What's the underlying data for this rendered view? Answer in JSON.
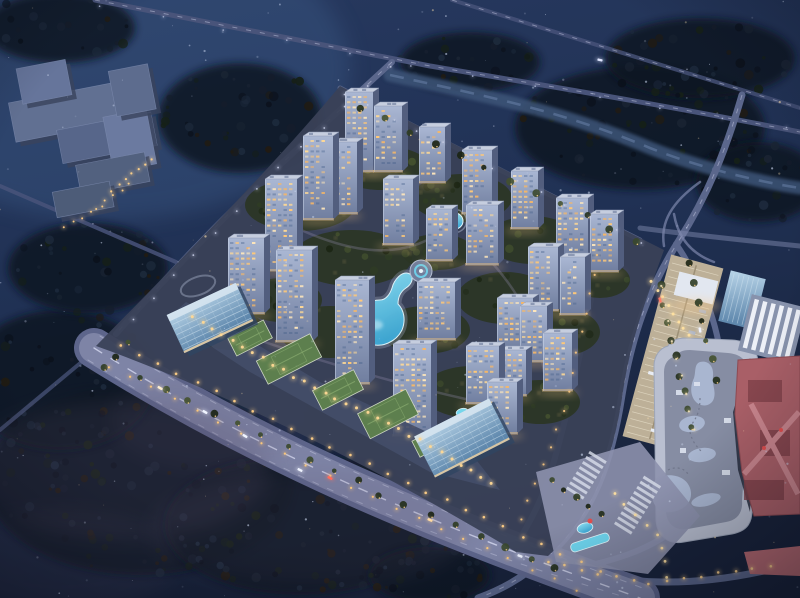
{
  "canvas": {
    "w": 800,
    "h": 598,
    "seed": 20240613
  },
  "palette": {
    "skyTop": "#27395f",
    "skyMid": "#203154",
    "skyLow": "#18223a",
    "glowTL": "#41608f",
    "forestBase": "#0f1420",
    "forestPuffs": [
      "#0b111c",
      "#151d2b",
      "#1a2433",
      "#162017",
      "#211b12",
      "#1d2a3c"
    ],
    "mist": "#5a4f6b",
    "river": "#3e5478",
    "riverHi": "#6d85ad",
    "roadDark": "#49547a",
    "road": "#5b678c",
    "roadLight": "#7d87ac",
    "laneLine": "#c7cce4",
    "avenue": "#7e84a6",
    "avenueEdge": "#5d658b",
    "compound": "#3a4157",
    "greenPatch": "#2b3524",
    "greenPuffs": [
      "#222d1a",
      "#2f3c24",
      "#3a482c",
      "#1b2413",
      "#44512f"
    ],
    "treeWarm": "#ffd28a",
    "towerTop": "#aab7d3",
    "towerBottom": "#707e9f",
    "towerSide": "#525e7e",
    "roof": "#c6cedf",
    "roofUnit": "#8d99b4",
    "winWarm": [
      "#ffd994",
      "#ffc877",
      "#ffe7bb",
      "#f7b766"
    ],
    "winCool": "#3d5884",
    "baseGlow": "#ffcf8e",
    "glassDark": "#5f88ad",
    "glassLine": "#d2e4f0",
    "greenRoof": "#5d7f4e",
    "greenRoofLine": "#86a86d",
    "greenRoofEdge": "#cdd6c2",
    "poolDeep": "#3fa9d6",
    "pool": "#6fd6ef",
    "poolEdge": "#e2f6fc",
    "mall": "#b9bfd0",
    "mallRoof": "#868da3",
    "mallBlob": "#a9b6d0",
    "mallSky": "#dde2ee",
    "tan": "#bdb098",
    "tanLine": "#e6dec9",
    "pink": "#a95f67",
    "pinkDark": "#7e4049",
    "pinkLight": "#c9858d",
    "red": "#e14e4e",
    "plaza": "#8d91ad",
    "stripe": "#dadeeb",
    "speck": "#cfdaf2",
    "speckWarm": "#ffe3b2",
    "schoolShadow": "#39435c",
    "schoolBlocks": [
      "#617092",
      "#57668a",
      "#66759b",
      "#6b7aa0",
      "#52617f",
      "#5d6c8e",
      "#4d5c78"
    ]
  },
  "scene": {
    "forest": [
      [
        140,
        480,
        155,
        95,
        95
      ],
      [
        300,
        525,
        135,
        70,
        70
      ],
      [
        60,
        380,
        95,
        70,
        50
      ],
      [
        430,
        575,
        60,
        28,
        25
      ],
      [
        240,
        118,
        82,
        55,
        42
      ],
      [
        60,
        28,
        75,
        35,
        25
      ],
      [
        640,
        128,
        125,
        62,
        55
      ],
      [
        758,
        182,
        62,
        40,
        25
      ],
      [
        88,
        268,
        80,
        45,
        35
      ],
      [
        700,
        58,
        95,
        40,
        30
      ],
      [
        470,
        62,
        70,
        30,
        22
      ]
    ],
    "river": {
      "d": "M390,75 C480,95 560,110 650,148 C700,168 760,182 800,188"
    },
    "roads": [
      {
        "d": "M95,0 L430,66 C560,88 680,108 800,132",
        "w": 5,
        "c": "roadDark",
        "line": 1
      },
      {
        "d": "M452,0 L800,108",
        "w": 4,
        "c": "roadDark",
        "o": 0.8,
        "line": 1
      },
      {
        "d": "M742,95 C726,150 708,195 678,242 C648,290 632,335 622,395 C612,460 594,515 548,556 C520,580 500,590 478,598",
        "w": 7,
        "c": "road",
        "line": 1
      },
      {
        "d": "M392,62 L268,176 C220,220 158,286 116,334",
        "w": 6,
        "c": "road",
        "line": 1
      },
      {
        "d": "M340,88 C430,135 520,180 640,240",
        "w": 5,
        "c": "road",
        "o": 0.9
      },
      {
        "d": "M600,252 C585,330 572,400 552,468 C545,492 532,520 514,548",
        "w": 6,
        "c": "road"
      },
      {
        "d": "M676,244 C706,288 720,330 724,382 C727,436 718,478 688,516 C664,544 624,560 566,570",
        "w": 6,
        "c": "road"
      },
      {
        "d": "M176,262 L0,186",
        "w": 4,
        "c": "roadDark",
        "o": 0.85
      },
      {
        "d": "M96,350 L0,430",
        "w": 4,
        "c": "roadDark",
        "o": 0.75
      },
      {
        "d": "M640,228 C700,236 760,242 800,246",
        "w": 5,
        "c": "roadLight",
        "o": 0.5
      },
      {
        "d": "M700,182 C672,202 660,222 664,246",
        "w": 2.5,
        "c": "roadLight",
        "o": 0.7
      },
      {
        "d": "M714,262 C692,254 678,238 674,214",
        "w": 2.5,
        "c": "roadLight",
        "o": 0.7
      },
      {
        "d": "M540,560 C620,588 700,590 800,562",
        "w": 7,
        "c": "road"
      },
      {
        "d": "M94,348 C260,452 420,520 640,598",
        "w": 30,
        "c": "avenue",
        "under": {
          "w": 40,
          "c": "avenueEdge"
        }
      },
      {
        "d": "M94,348 C260,452 420,520 640,598",
        "w": 1.4,
        "c": "#d6daf0",
        "o": 0.8,
        "dash": "9 11"
      },
      {
        "d": "M100,336 C266,440 426,508 648,590",
        "w": 1,
        "c": "laneLine",
        "o": 0.5,
        "dash": "6 10"
      },
      {
        "d": "M88,360 C254,464 414,534 628,598",
        "w": 1,
        "c": "laneLine",
        "o": 0.45,
        "dash": "6 10"
      }
    ],
    "mist": [
      [
        120,
        470,
        150,
        70,
        0.2
      ],
      [
        310,
        530,
        160,
        60,
        0.16
      ],
      [
        210,
        420,
        100,
        50,
        0.12
      ],
      [
        60,
        560,
        120,
        50,
        0.15
      ]
    ],
    "compound": {
      "outline": "M340,86 C450,142 560,198 664,250 C646,300 630,340 622,398 C612,462 592,516 548,556 L516,552 C380,470 230,394 96,346 C180,260 270,170 340,86 Z",
      "paths": [
        {
          "d": "M280,220 C340,250 400,268 452,224",
          "o": 0.3
        },
        {
          "d": "M230,330 C300,355 380,380 470,400",
          "o": 0.3
        },
        {
          "d": "M480,250 C520,290 540,330 545,380",
          "o": 0.3
        }
      ],
      "ringPark": [
        198,
        286,
        18,
        9,
        -20
      ]
    },
    "greenPatches": [
      [
        300,
        205,
        55,
        26,
        12
      ],
      [
        382,
        168,
        48,
        22,
        10
      ],
      [
        462,
        198,
        50,
        24,
        10
      ],
      [
        532,
        240,
        45,
        24,
        9
      ],
      [
        352,
        258,
        60,
        28,
        12
      ],
      [
        438,
        252,
        36,
        18,
        8
      ],
      [
        505,
        298,
        48,
        26,
        10
      ],
      [
        560,
        332,
        40,
        24,
        8
      ],
      [
        330,
        332,
        50,
        26,
        10
      ],
      [
        425,
        330,
        45,
        24,
        9
      ],
      [
        472,
        392,
        50,
        26,
        10
      ],
      [
        540,
        402,
        40,
        22,
        8
      ],
      [
        282,
        300,
        40,
        22,
        8
      ],
      [
        600,
        280,
        30,
        18,
        6
      ],
      [
        230,
        330,
        35,
        20,
        7
      ]
    ],
    "water": {
      "guitar": "M410,274 C414,278 412,284 406,288 C400,292 398,298 398,304 C404,310 406,320 402,330 C396,342 382,348 370,344 C358,340 352,328 356,316 C360,306 370,300 380,300 C386,300 390,294 392,288 C394,280 402,270 410,274 Z",
      "fountain": [
        421,
        271
      ],
      "pond": [
        455,
        221
      ],
      "mini": [
        462,
        412
      ]
    },
    "towers": [
      [
        345,
        92,
        28,
        80
      ],
      [
        374,
        106,
        28,
        66
      ],
      [
        419,
        127,
        26,
        56
      ],
      [
        303,
        136,
        30,
        84
      ],
      [
        334,
        142,
        23,
        72
      ],
      [
        462,
        150,
        30,
        64
      ],
      [
        511,
        171,
        27,
        58
      ],
      [
        556,
        198,
        32,
        60
      ],
      [
        590,
        214,
        28,
        58
      ],
      [
        265,
        179,
        32,
        92
      ],
      [
        383,
        179,
        30,
        66
      ],
      [
        466,
        205,
        32,
        60
      ],
      [
        426,
        209,
        26,
        52
      ],
      [
        228,
        238,
        36,
        76
      ],
      [
        276,
        250,
        36,
        92
      ],
      [
        528,
        247,
        30,
        64
      ],
      [
        560,
        257,
        25,
        58
      ],
      [
        335,
        280,
        34,
        104
      ],
      [
        417,
        282,
        38,
        58
      ],
      [
        497,
        298,
        36,
        52
      ],
      [
        520,
        306,
        27,
        56
      ],
      [
        543,
        333,
        29,
        58
      ],
      [
        466,
        346,
        33,
        58
      ],
      [
        500,
        350,
        26,
        46
      ],
      [
        393,
        344,
        38,
        92
      ],
      [
        487,
        382,
        30,
        52
      ]
    ],
    "retail": {
      "podium": "M186,302 L320,382 L470,452 L500,490 L430,472 L250,372 L168,318 Z",
      "greenRoofs": [
        [
          289,
          359,
          60,
          26,
          -27
        ],
        [
          338,
          390,
          46,
          22,
          -27
        ],
        [
          388,
          414,
          54,
          28,
          -27
        ],
        [
          432,
          441,
          36,
          18,
          -27
        ],
        [
          250,
          338,
          40,
          20,
          -27
        ]
      ],
      "offices": [
        [
          210,
          318,
          76,
          42,
          -25
        ],
        [
          462,
          438,
          84,
          46,
          -27
        ]
      ]
    },
    "school": {
      "rot": [
        -11,
        90,
        135
      ],
      "blocks": [
        [
          16,
          88,
          110,
          40,
          0
        ],
        [
          58,
          124,
          96,
          34,
          1
        ],
        [
          30,
          56,
          50,
          36,
          2
        ],
        [
          106,
          120,
          44,
          56,
          3
        ],
        [
          70,
          162,
          70,
          30,
          4
        ],
        [
          120,
          76,
          40,
          46,
          5
        ],
        [
          42,
          184,
          58,
          26,
          6
        ]
      ]
    },
    "mall": {
      "body": "M668,346 C660,348 654,356 654,366 L656,520 C657,536 668,545 684,542 L732,534 C748,531 753,522 752,506 L760,392 L758,362 C757,348 748,341 732,340 L686,338 C676,338 671,341 668,346 Z",
      "roof": "M676,356 C668,358 664,364 664,372 L666,512 C667,524 675,531 688,529 L726,522 C738,520 743,512 742,500 L750,392 L748,370 C747,360 740,354 728,353 L690,350 C682,350 679,352 676,356 Z",
      "blobPaths": [
        "M700,362 C708,360 714,366 713,376 C712,386 716,390 714,398 C712,406 702,408 696,402 C690,396 690,386 694,378 C696,372 694,364 700,362 Z",
        "M658,478 C670,472 686,476 690,488 C694,500 686,510 672,512 C660,514 652,506 652,494 C652,486 652,482 658,478 Z"
      ],
      "blobEllipses": [
        [
          692,
          424,
          13,
          8,
          -10
        ],
        [
          702,
          455,
          14,
          7,
          -8
        ],
        [
          706,
          500,
          15,
          6,
          -14
        ]
      ],
      "skylights": [
        [
          738,
          372,
          8,
          5
        ],
        [
          676,
          390,
          7,
          5
        ],
        [
          724,
          418,
          7,
          5
        ],
        [
          680,
          448,
          6,
          5
        ],
        [
          722,
          470,
          8,
          5
        ],
        [
          694,
          382,
          6,
          4
        ]
      ],
      "dots": [
        "M700,398 C700,412 696,418 692,424",
        "M690,432 C692,442 698,448 702,452",
        "M668,470 C676,466 684,468 688,474"
      ],
      "pavilion": [
        676,
        276,
        40,
        24,
        14
      ],
      "glassTower": [
        724,
        274,
        36,
        52,
        14
      ],
      "slab": [
        744,
        300,
        56,
        58,
        14
      ],
      "parking": {
        "rot": [
          15,
          672,
          352
        ],
        "rect": [
          646,
          258,
          54,
          188
        ]
      },
      "gap": "M750,358 L758,392 L750,512 L738,470 L733,412 Z",
      "pink": {
        "body": "M738,360 L800,356 L800,514 L754,516 L742,472 L735,414 Z",
        "inner": [
          [
            748,
            380,
            34,
            22
          ],
          [
            760,
            430,
            30,
            26
          ],
          [
            744,
            480,
            40,
            20
          ]
        ],
        "bridges": [
          "M744,474 L799,412",
          "M751,404 L798,494"
        ],
        "accents": [
          [
            764,
            448
          ],
          [
            781,
            430
          ]
        ],
        "canopy": "M744,552 L800,546 L800,576 L750,574 Z"
      }
    },
    "plaza": {
      "poly": "M536,472 L640,442 L700,516 L648,574 L556,562 Z",
      "crosswalks": [
        [
          566,
          489,
          -58,
          8
        ],
        [
          614,
          524,
          -58,
          10
        ]
      ],
      "poolDrop": [
        585,
        528,
        8,
        5,
        -15
      ],
      "poolBar": [
        570,
        538,
        40,
        9,
        -18
      ],
      "red": [
        590,
        521
      ]
    },
    "treeRows": [
      {
        "pts": [
          [
            140,
            378
          ],
          [
            360,
            482
          ]
        ],
        "n": 10
      },
      {
        "pts": [
          [
            380,
            494
          ],
          [
            556,
            570
          ]
        ],
        "n": 8
      },
      {
        "pts": [
          [
            660,
            286
          ],
          [
            693,
            428
          ]
        ],
        "n": 9
      },
      {
        "pts": [
          [
            688,
            262
          ],
          [
            716,
            380
          ]
        ],
        "n": 7
      },
      {
        "pts": [
          [
            360,
            108
          ],
          [
            636,
            240
          ]
        ],
        "n": 12
      },
      {
        "pts": [
          [
            552,
            480
          ],
          [
            600,
            514
          ]
        ],
        "n": 5
      },
      {
        "pts": [
          [
            128,
            344
          ],
          [
            104,
            368
          ]
        ],
        "n": 3
      }
    ],
    "lightStrings": [
      {
        "pts": [
          [
            120,
            346
          ],
          [
            350,
            456
          ],
          [
            600,
            572
          ]
        ],
        "n": 26,
        "c": "#ffcf86",
        "r": 1.3
      },
      {
        "pts": [
          [
            108,
            366
          ],
          [
            340,
            482
          ],
          [
            576,
            590
          ]
        ],
        "n": 22,
        "c": "#ffc979",
        "r": 1.1
      },
      {
        "pts": [
          [
            192,
            316
          ],
          [
            300,
            380
          ],
          [
            420,
            440
          ],
          [
            492,
            482
          ]
        ],
        "n": 30,
        "c": "#ffd894",
        "r": 1.5
      },
      {
        "pts": [
          [
            598,
            256
          ],
          [
            564,
            412
          ],
          [
            520,
            520
          ]
        ],
        "n": 15,
        "c": "#f2c27e",
        "r": 1.1
      },
      {
        "pts": [
          [
            652,
            282
          ],
          [
            688,
            336
          ]
        ],
        "n": 8,
        "c": "#ffe0a0",
        "r": 1.5
      },
      {
        "pts": [
          [
            548,
            562
          ],
          [
            650,
            584
          ],
          [
            770,
            566
          ]
        ],
        "n": 14,
        "c": "#ffd28a",
        "r": 1.3
      },
      {
        "pts": [
          [
            390,
            66
          ],
          [
            270,
            176
          ],
          [
            132,
            320
          ]
        ],
        "n": 13,
        "c": "#c3c9e2",
        "r": 0.9
      },
      {
        "pts": [
          [
            660,
            286
          ],
          [
            694,
            430
          ]
        ],
        "n": 9,
        "c": "#e8d9b4",
        "r": 1.1
      },
      {
        "pts": [
          [
            100,
            6
          ],
          [
            430,
            68
          ],
          [
            786,
            128
          ]
        ],
        "n": 12,
        "c": "#aab3d4",
        "r": 0.8
      },
      {
        "pts": [
          [
            112,
            190
          ],
          [
            152,
            158
          ]
        ],
        "n": 7,
        "c": "#ffd28a",
        "r": 1.1
      },
      {
        "pts": [
          [
            96,
            208
          ],
          [
            130,
            183
          ]
        ],
        "n": 5,
        "c": "#ffd28a",
        "r": 1.0
      },
      {
        "pts": [
          [
            64,
            228
          ],
          [
            102,
            206
          ]
        ],
        "n": 5,
        "c": "#ffcf86",
        "r": 1.0
      },
      {
        "pts": [
          [
            344,
            94
          ],
          [
            640,
            242
          ]
        ],
        "n": 13,
        "c": "#c3c9e2",
        "r": 0.9
      },
      {
        "pts": [
          [
            614,
            494
          ],
          [
            662,
            540
          ],
          [
            668,
            576
          ]
        ],
        "n": 8,
        "c": "#ffe0a0",
        "r": 1.4
      }
    ],
    "cars": [
      [
        205,
        412,
        30,
        "#f0f4ff"
      ],
      [
        245,
        436,
        30,
        "#f0f4ff"
      ],
      [
        330,
        478,
        27,
        "#ff6a5a"
      ],
      [
        300,
        470,
        27,
        "#f0f4ff"
      ],
      [
        430,
        520,
        24,
        "#ffd9a0"
      ],
      [
        520,
        556,
        22,
        "#f0f4ff"
      ],
      [
        600,
        60,
        12,
        "#dfe6ff"
      ],
      [
        700,
        330,
        80,
        "#eef2ff"
      ],
      [
        660,
        300,
        75,
        "#ff7a66"
      ],
      [
        160,
        388,
        30,
        "#ffefcf"
      ]
    ],
    "specks": {
      "n": 230,
      "warmRatio": 0.12
    }
  }
}
